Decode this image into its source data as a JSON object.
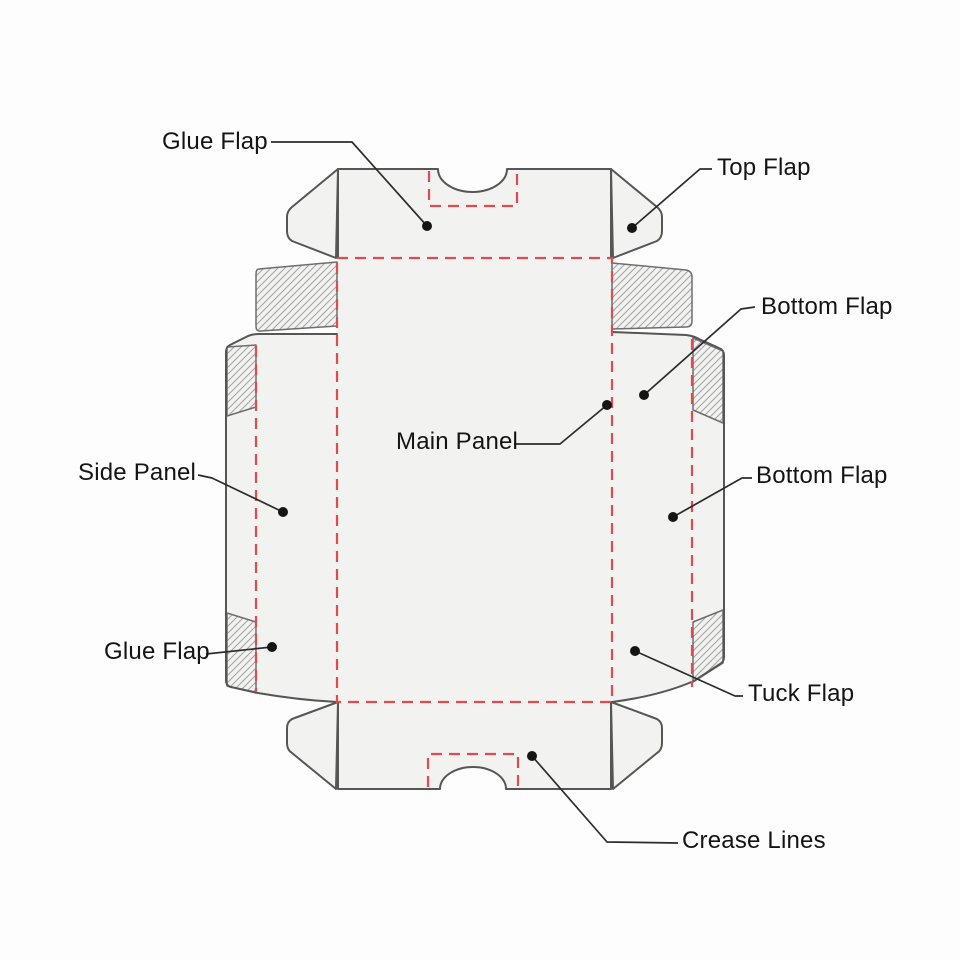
{
  "diagram": {
    "labels": {
      "glue_flap_top": "Glue Flap",
      "top_flap": "Top Flap",
      "bottom_flap_upper": "Bottom Flap",
      "main_panel": "Main Panel",
      "bottom_flap_lower": "Bottom Flap",
      "side_panel": "Side Panel",
      "glue_flap_bottom": "Glue Flap",
      "tuck_flap": "Tuck Flap",
      "crease_lines": "Crease Lines"
    },
    "colors": {
      "background": "#fdfdfd",
      "panel_fill": "#f2f2f0",
      "outline": "#565656",
      "crease_dash": "#e04c4c",
      "hatch_line": "#a6a6a6",
      "hatch_edge": "#6e6e6e",
      "leader": "#2b2b2b",
      "label_text": "#141414"
    }
  }
}
